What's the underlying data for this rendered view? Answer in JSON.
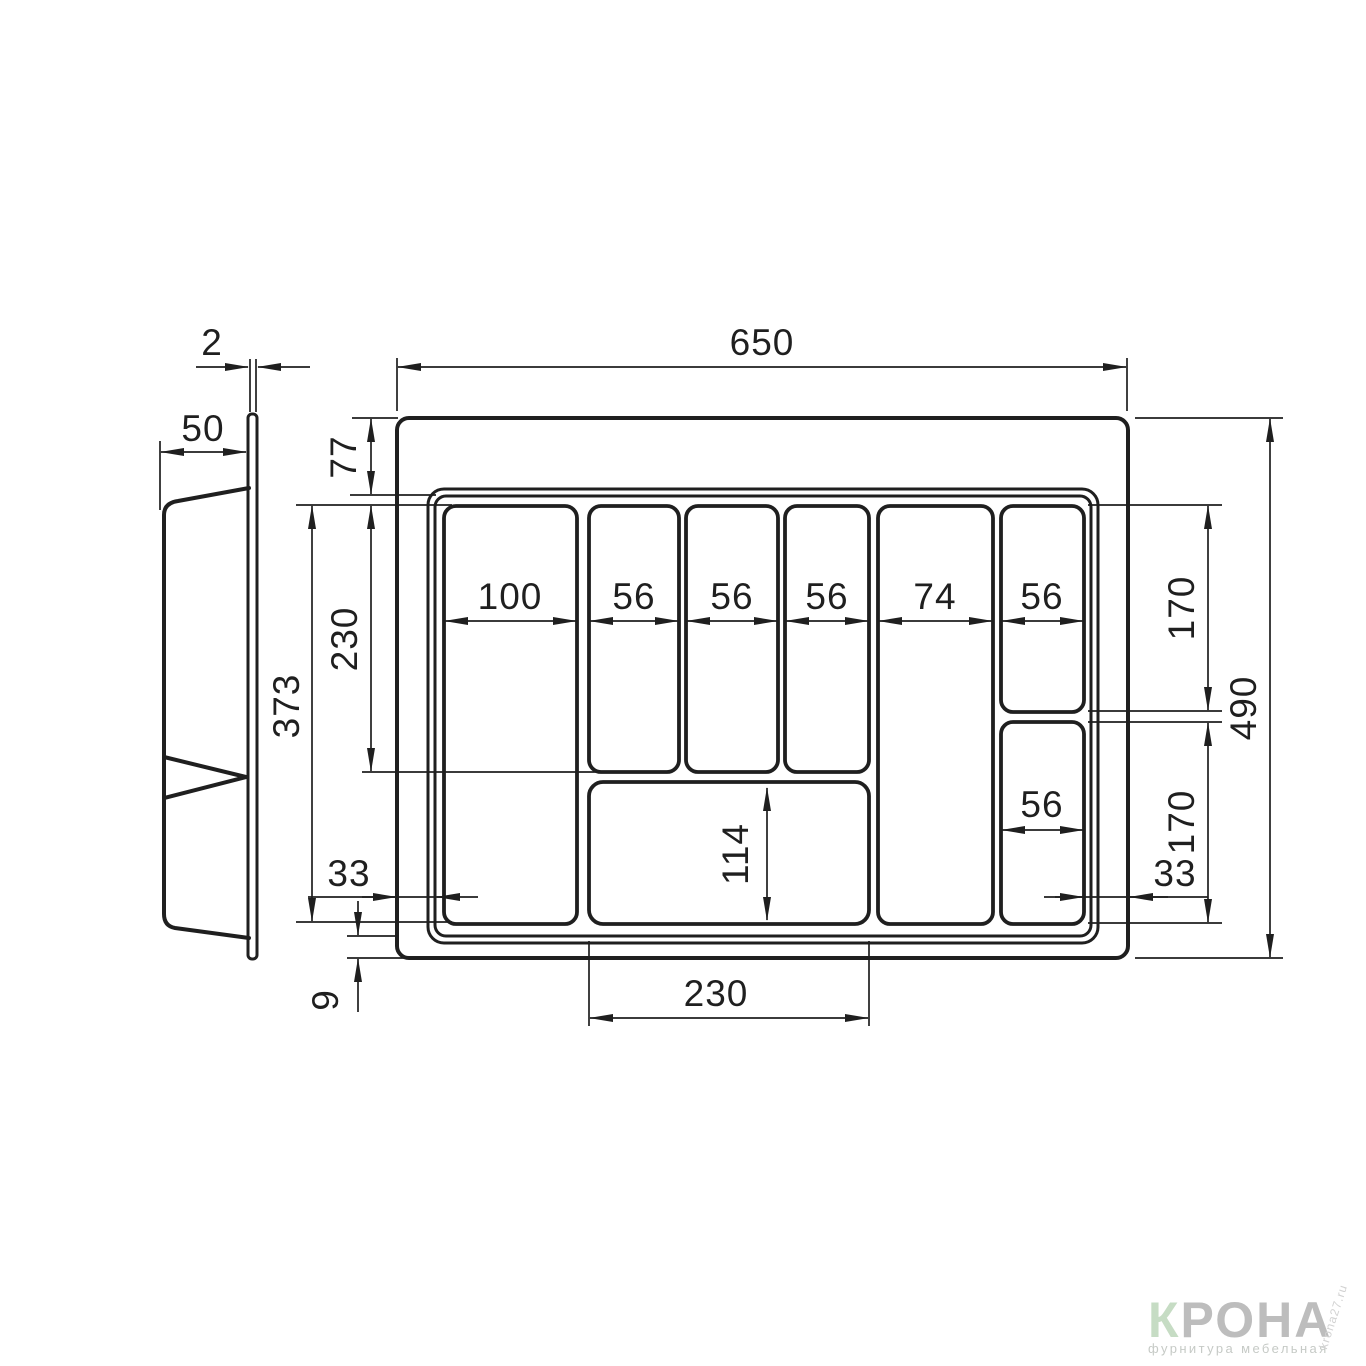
{
  "drawing": {
    "kind": "technical-drawing",
    "subject": "cutlery tray insert for drawer, top view and side profile",
    "units": "mm",
    "line_color": "#1f1f1f",
    "background": "#ffffff"
  },
  "side_view": {
    "plate_thickness": "2",
    "flange_width": "50"
  },
  "top_view": {
    "overall_width": "650",
    "overall_depth": "490",
    "top_rim_offset": "77",
    "upper_row_depth": "230",
    "inner_depth": "373",
    "left_inset": "33",
    "right_inset": "33",
    "bottom_rim_offset": "9",
    "bottom_slot_width": "230",
    "bottom_slot_depth": "114",
    "right_top_slot_depth": "170",
    "right_bottom_slot_depth": "170",
    "right_bottom_slot_width": "56",
    "columns": [
      {
        "label": "100"
      },
      {
        "label": "56"
      },
      {
        "label": "56"
      },
      {
        "label": "56"
      },
      {
        "label": "74"
      },
      {
        "label": "56"
      }
    ]
  },
  "watermark": {
    "brand_initial": "К",
    "brand_rest": "РОНА",
    "tagline": "фурнитура мебельная",
    "site_note": "krona27.ru",
    "initial_color": "#c6dcc4",
    "brand_color": "#bdbdbd",
    "tagline_color": "#c6cac6",
    "site_color": "#d2d2d2"
  }
}
